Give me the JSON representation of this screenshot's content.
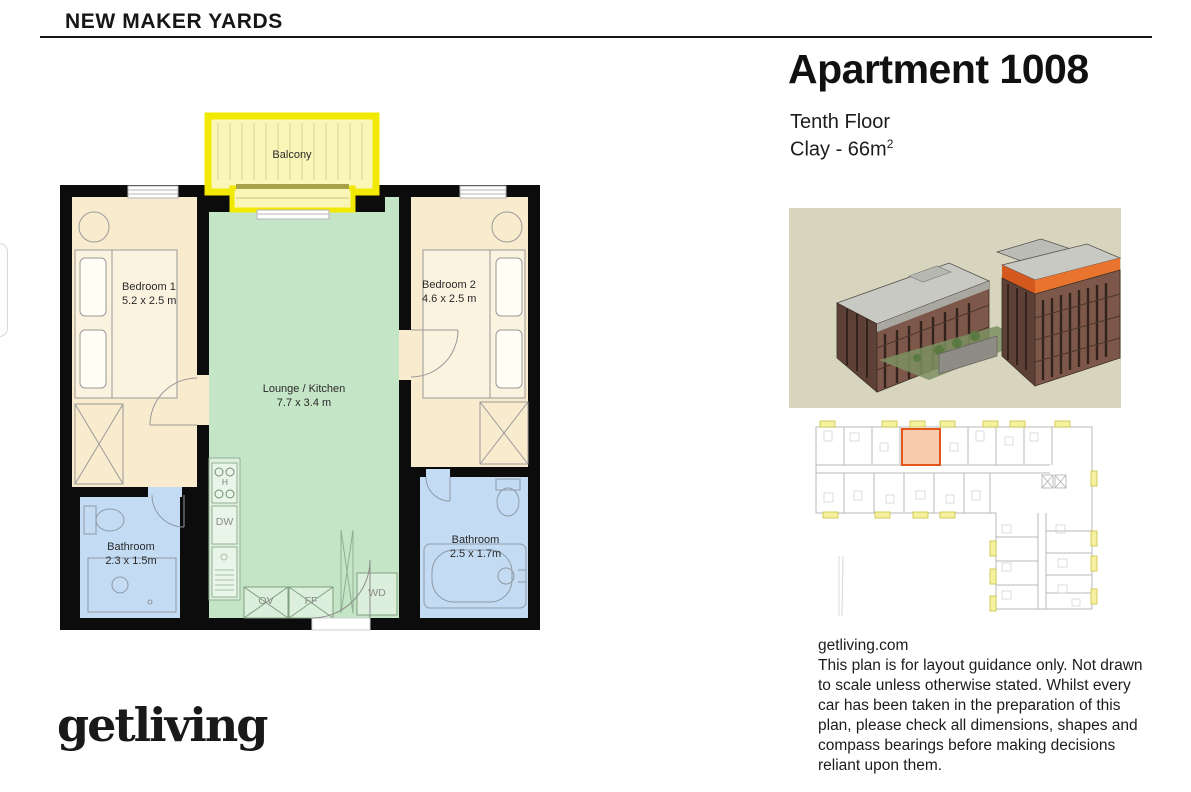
{
  "header": {
    "project": "NEW MAKER YARDS"
  },
  "apartment": {
    "title": "Apartment 1008",
    "floor": "Tenth Floor",
    "type": "Clay - 66m",
    "area_sup": "2"
  },
  "floorplan": {
    "balcony": {
      "label": "Balcony"
    },
    "bedroom1": {
      "label": "Bedroom 1",
      "dims": "5.2 x 2.5 m"
    },
    "bedroom2": {
      "label": "Bedroom 2",
      "dims": "4.6 x 2.5 m"
    },
    "lounge": {
      "label": "Lounge / Kitchen",
      "dims": "7.7 x 3.4 m"
    },
    "bathroom1": {
      "label": "Bathroom",
      "dims": "2.3 x 1.5m"
    },
    "bathroom2": {
      "label": "Bathroom",
      "dims": "2.5 x 1.7m"
    },
    "appliances": {
      "hob": "H",
      "dw": "DW",
      "ov": "OV",
      "ff": "FF",
      "wd": "WD"
    }
  },
  "info": {
    "website": "getliving.com",
    "disclaimer": "This plan is for layout guidance only. Not drawn to scale unless otherwise stated. Whilst every car has been taken in the preparation of this plan, please check all dimensions, shapes and compass bearings before making decisions reliant upon them."
  },
  "footer": {
    "logo": "getliving"
  },
  "colors": {
    "wall_black": "#0c0c0c",
    "bedroom_cream": "#f9ecce",
    "lounge_green": "#c5e5c7",
    "bathroom_blue": "#c3dcf3",
    "balcony_fill": "#f9f6b8",
    "balcony_border": "#f2e900",
    "highlight_orange": "#e2571c",
    "render_background": "#d8d5bf"
  }
}
